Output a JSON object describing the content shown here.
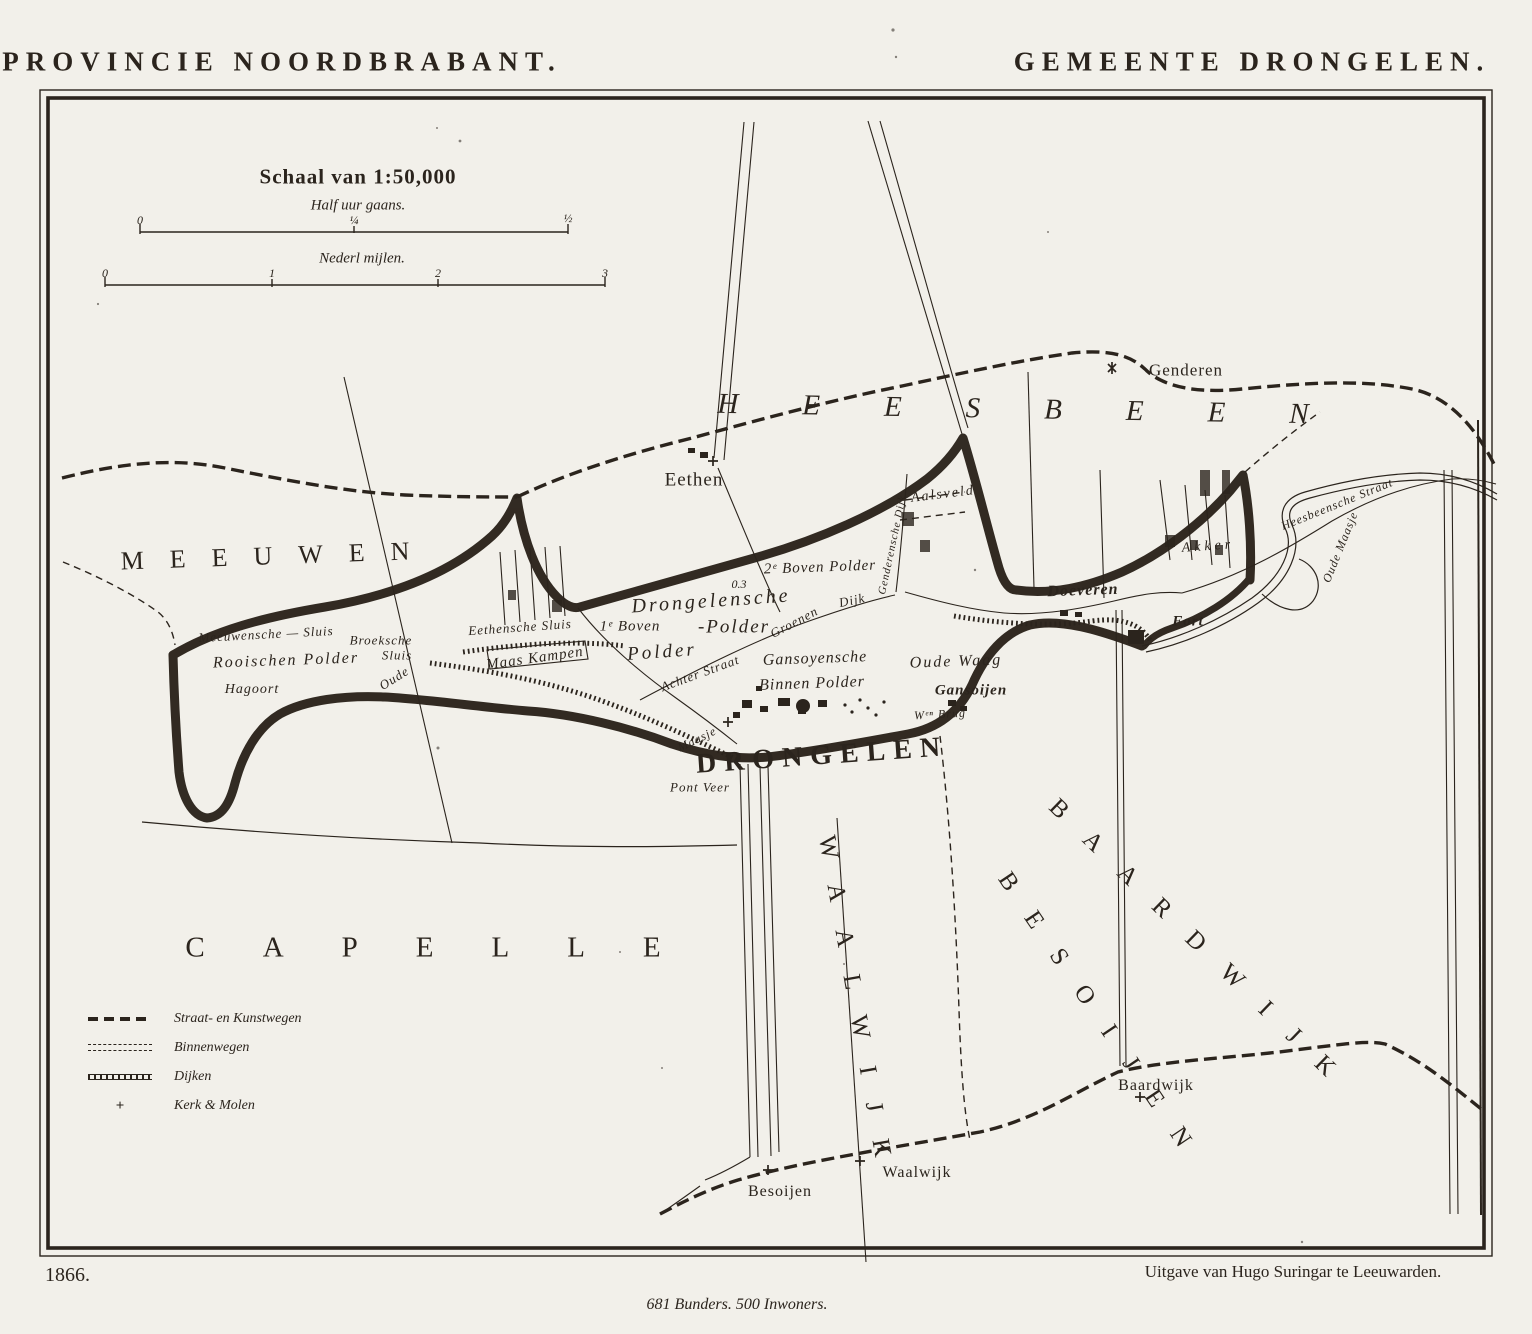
{
  "page": {
    "title_left": "PROVINCIE NOORDBRABANT.",
    "title_right": "GEMEENTE DRONGELEN.",
    "year": "1866.",
    "publisher": "Uitgave van Hugo Suringar te Leeuwarden.",
    "statistics": "681 Bunders. 500 Inwoners."
  },
  "scale": {
    "heading": "Schaal van 1:50,000",
    "bar1": {
      "label": "Half uur gaans.",
      "ticks": [
        "0",
        "¼",
        "½"
      ]
    },
    "bar2": {
      "label": "Nederl mijlen.",
      "ticks": [
        "0",
        "1",
        "2",
        "3"
      ]
    }
  },
  "legend": {
    "items": [
      {
        "symbol": "road-dashed-icon",
        "label": "Straat- en Kunstwegen"
      },
      {
        "symbol": "road-double-icon",
        "label": "Binnenwegen"
      },
      {
        "symbol": "dike-hatched-icon",
        "label": "Dijken"
      },
      {
        "symbol": "church-cross-icon",
        "label": "Kerk & Molen"
      }
    ]
  },
  "colors": {
    "ink": "#2b241d",
    "paper": "#f2f0ea",
    "boundary": "#241c13"
  },
  "map": {
    "labels": [
      {
        "id": "region-meeuwen",
        "text": "MEEUWEN",
        "x": 278,
        "y": 556,
        "fs": 26,
        "ls": 26,
        "rot": -2,
        "cls": "caps"
      },
      {
        "id": "region-heesbeen",
        "text": "HEESBEEN",
        "x": 1045,
        "y": 410,
        "fs": 29,
        "ls": 64,
        "rot": 1,
        "cls": "caps caps-italic"
      },
      {
        "id": "region-capelle",
        "text": "CAPELLE",
        "x": 452,
        "y": 948,
        "fs": 29,
        "ls": 58,
        "rot": 0,
        "cls": "caps"
      },
      {
        "id": "region-besoijen",
        "text": "BESOIJEN",
        "x": 1103,
        "y": 1022,
        "fs": 25,
        "ls": 30,
        "rot": 56,
        "cls": "caps"
      },
      {
        "id": "region-waalwijk",
        "text": "WAALWIJK",
        "x": 857,
        "y": 1010,
        "fs": 25,
        "ls": 28,
        "rot": 80,
        "cls": "caps"
      },
      {
        "id": "region-baardwijk",
        "text": "BAARDWIJK",
        "x": 1203,
        "y": 948,
        "fs": 25,
        "ls": 30,
        "rot": 44,
        "cls": "caps"
      },
      {
        "id": "town-drongelen",
        "text": "DRONGELEN",
        "x": 822,
        "y": 756,
        "fs": 28,
        "ls": 8,
        "rot": -4,
        "cls": "caps-bold"
      },
      {
        "id": "drongelensche",
        "text": "Drongelensche",
        "x": 711,
        "y": 601,
        "fs": 20,
        "ls": 3,
        "rot": -4,
        "cls": "italic"
      },
      {
        "id": "drongelensche-polder",
        "text": "-Polder",
        "x": 734,
        "y": 627,
        "fs": 19,
        "ls": 2,
        "rot": 0,
        "cls": "italic"
      },
      {
        "id": "boven1-polder",
        "text": "1ᵉ Boven",
        "x": 630,
        "y": 627,
        "fs": 15,
        "ls": 1,
        "rot": 0,
        "cls": "italic"
      },
      {
        "id": "boven1-polder2",
        "text": "Polder",
        "x": 662,
        "y": 652,
        "fs": 19,
        "ls": 3,
        "rot": -4,
        "cls": "italic"
      },
      {
        "id": "height-mark",
        "text": "0.3",
        "x": 739,
        "y": 584,
        "fs": 12,
        "ls": 0,
        "rot": 0,
        "cls": "italic"
      },
      {
        "id": "boven2-polder",
        "text": "2ᵉ Boven Polder",
        "x": 820,
        "y": 568,
        "fs": 15,
        "ls": 1,
        "rot": -2,
        "cls": "italic"
      },
      {
        "id": "groenen-dijk-a",
        "text": "Groenen",
        "x": 794,
        "y": 622,
        "fs": 13,
        "ls": 1,
        "rot": -28,
        "cls": "italic"
      },
      {
        "id": "groenen-dijk-b",
        "text": "Dijk",
        "x": 852,
        "y": 600,
        "fs": 13,
        "ls": 1,
        "rot": -12,
        "cls": "italic"
      },
      {
        "id": "achter-straat",
        "text": "Achter Straat",
        "x": 700,
        "y": 673,
        "fs": 13,
        "ls": 1,
        "rot": -20,
        "cls": "italic"
      },
      {
        "id": "gansoyensche",
        "text": "Gansoyensche",
        "x": 815,
        "y": 659,
        "fs": 16,
        "ls": 1,
        "rot": -2,
        "cls": "italic"
      },
      {
        "id": "binnen-polder",
        "text": "Binnen Polder",
        "x": 812,
        "y": 684,
        "fs": 16,
        "ls": 1,
        "rot": -2,
        "cls": "italic"
      },
      {
        "id": "oude-waag",
        "text": "Oude Waag",
        "x": 956,
        "y": 662,
        "fs": 16,
        "ls": 2,
        "rot": -2,
        "cls": "italic"
      },
      {
        "id": "gansoijen",
        "text": "Gansoijen",
        "x": 971,
        "y": 691,
        "fs": 15,
        "ls": 1,
        "rot": 0,
        "cls": "bold-italic"
      },
      {
        "id": "wen-brug",
        "text": "Wᵉⁿ Brug",
        "x": 940,
        "y": 714,
        "fs": 12,
        "ls": 1,
        "rot": -3,
        "cls": "italic"
      },
      {
        "id": "genderensche-dijk",
        "text": "Genderensche Dijk",
        "x": 893,
        "y": 545,
        "fs": 11,
        "ls": 1,
        "rot": -78,
        "cls": "italic"
      },
      {
        "id": "meeuwensche-sluis",
        "text": "Meeuwensche — Sluis",
        "x": 266,
        "y": 634,
        "fs": 13,
        "ls": 1,
        "rot": -3,
        "cls": "italic"
      },
      {
        "id": "broeksche",
        "text": "Broeksche",
        "x": 381,
        "y": 640,
        "fs": 13,
        "ls": 1,
        "rot": 0,
        "cls": "italic"
      },
      {
        "id": "broeksche-sluis",
        "text": "Sluis",
        "x": 397,
        "y": 655,
        "fs": 13,
        "ls": 1,
        "rot": 0,
        "cls": "italic"
      },
      {
        "id": "rooischen-polder",
        "text": "Rooischen Polder",
        "x": 286,
        "y": 661,
        "fs": 16,
        "ls": 2,
        "rot": -2,
        "cls": "italic"
      },
      {
        "id": "hagoort",
        "text": "Hagoort",
        "x": 252,
        "y": 690,
        "fs": 14,
        "ls": 1,
        "rot": 0,
        "cls": "italic"
      },
      {
        "id": "oude-weg",
        "text": "Oude",
        "x": 394,
        "y": 678,
        "fs": 13,
        "ls": 1,
        "rot": -32,
        "cls": "italic"
      },
      {
        "id": "eethensche-sluis",
        "text": "Eethensche Sluis",
        "x": 520,
        "y": 627,
        "fs": 13,
        "ls": 1,
        "rot": -4,
        "cls": "italic"
      },
      {
        "id": "maas-kampen",
        "text": "Maas Kampen",
        "x": 535,
        "y": 659,
        "fs": 15,
        "ls": 1,
        "rot": -8,
        "cls": "italic"
      },
      {
        "id": "village-eethen",
        "text": "Eethen",
        "x": 694,
        "y": 480,
        "fs": 19,
        "ls": 1,
        "rot": 0,
        "cls": "serif"
      },
      {
        "id": "village-genderen",
        "text": "Genderen",
        "x": 1186,
        "y": 370,
        "fs": 17,
        "ls": 1,
        "rot": 0,
        "cls": "serif"
      },
      {
        "id": "aalsveld",
        "text": "Aalsveld",
        "x": 943,
        "y": 495,
        "fs": 14,
        "ls": 2,
        "rot": -7,
        "cls": "italic"
      },
      {
        "id": "akker",
        "text": "Akker",
        "x": 1208,
        "y": 547,
        "fs": 14,
        "ls": 4,
        "rot": -4,
        "cls": "italic"
      },
      {
        "id": "doeveren",
        "text": "Doeveren",
        "x": 1083,
        "y": 591,
        "fs": 16,
        "ls": 1,
        "rot": -2,
        "cls": "bold-italic"
      },
      {
        "id": "fort",
        "text": "Fort",
        "x": 1188,
        "y": 622,
        "fs": 15,
        "ls": 1,
        "rot": 0,
        "cls": "bold-italic"
      },
      {
        "id": "heesbeensche-straat",
        "text": "Heesbeensche Straat",
        "x": 1337,
        "y": 504,
        "fs": 12,
        "ls": 1,
        "rot": -22,
        "cls": "italic"
      },
      {
        "id": "oude-maasje-east",
        "text": "Oude Maasje",
        "x": 1340,
        "y": 547,
        "fs": 12,
        "ls": 1,
        "rot": -68,
        "cls": "italic"
      },
      {
        "id": "maasje",
        "text": "Maasje",
        "x": 697,
        "y": 739,
        "fs": 12,
        "ls": 1,
        "rot": -26,
        "cls": "italic"
      },
      {
        "id": "pont-veer",
        "text": "Pont Veer",
        "x": 700,
        "y": 787,
        "fs": 13,
        "ls": 1,
        "rot": 0,
        "cls": "italic"
      },
      {
        "id": "village-besoijen",
        "text": "Besoijen",
        "x": 780,
        "y": 1192,
        "fs": 16,
        "ls": 1,
        "rot": 0,
        "cls": "serif"
      },
      {
        "id": "village-waalwijk",
        "text": "Waalwijk",
        "x": 917,
        "y": 1173,
        "fs": 16,
        "ls": 1,
        "rot": 0,
        "cls": "serif"
      },
      {
        "id": "village-baardwijk",
        "text": "Baardwijk",
        "x": 1156,
        "y": 1086,
        "fs": 16,
        "ls": 1,
        "rot": 0,
        "cls": "serif"
      }
    ]
  }
}
